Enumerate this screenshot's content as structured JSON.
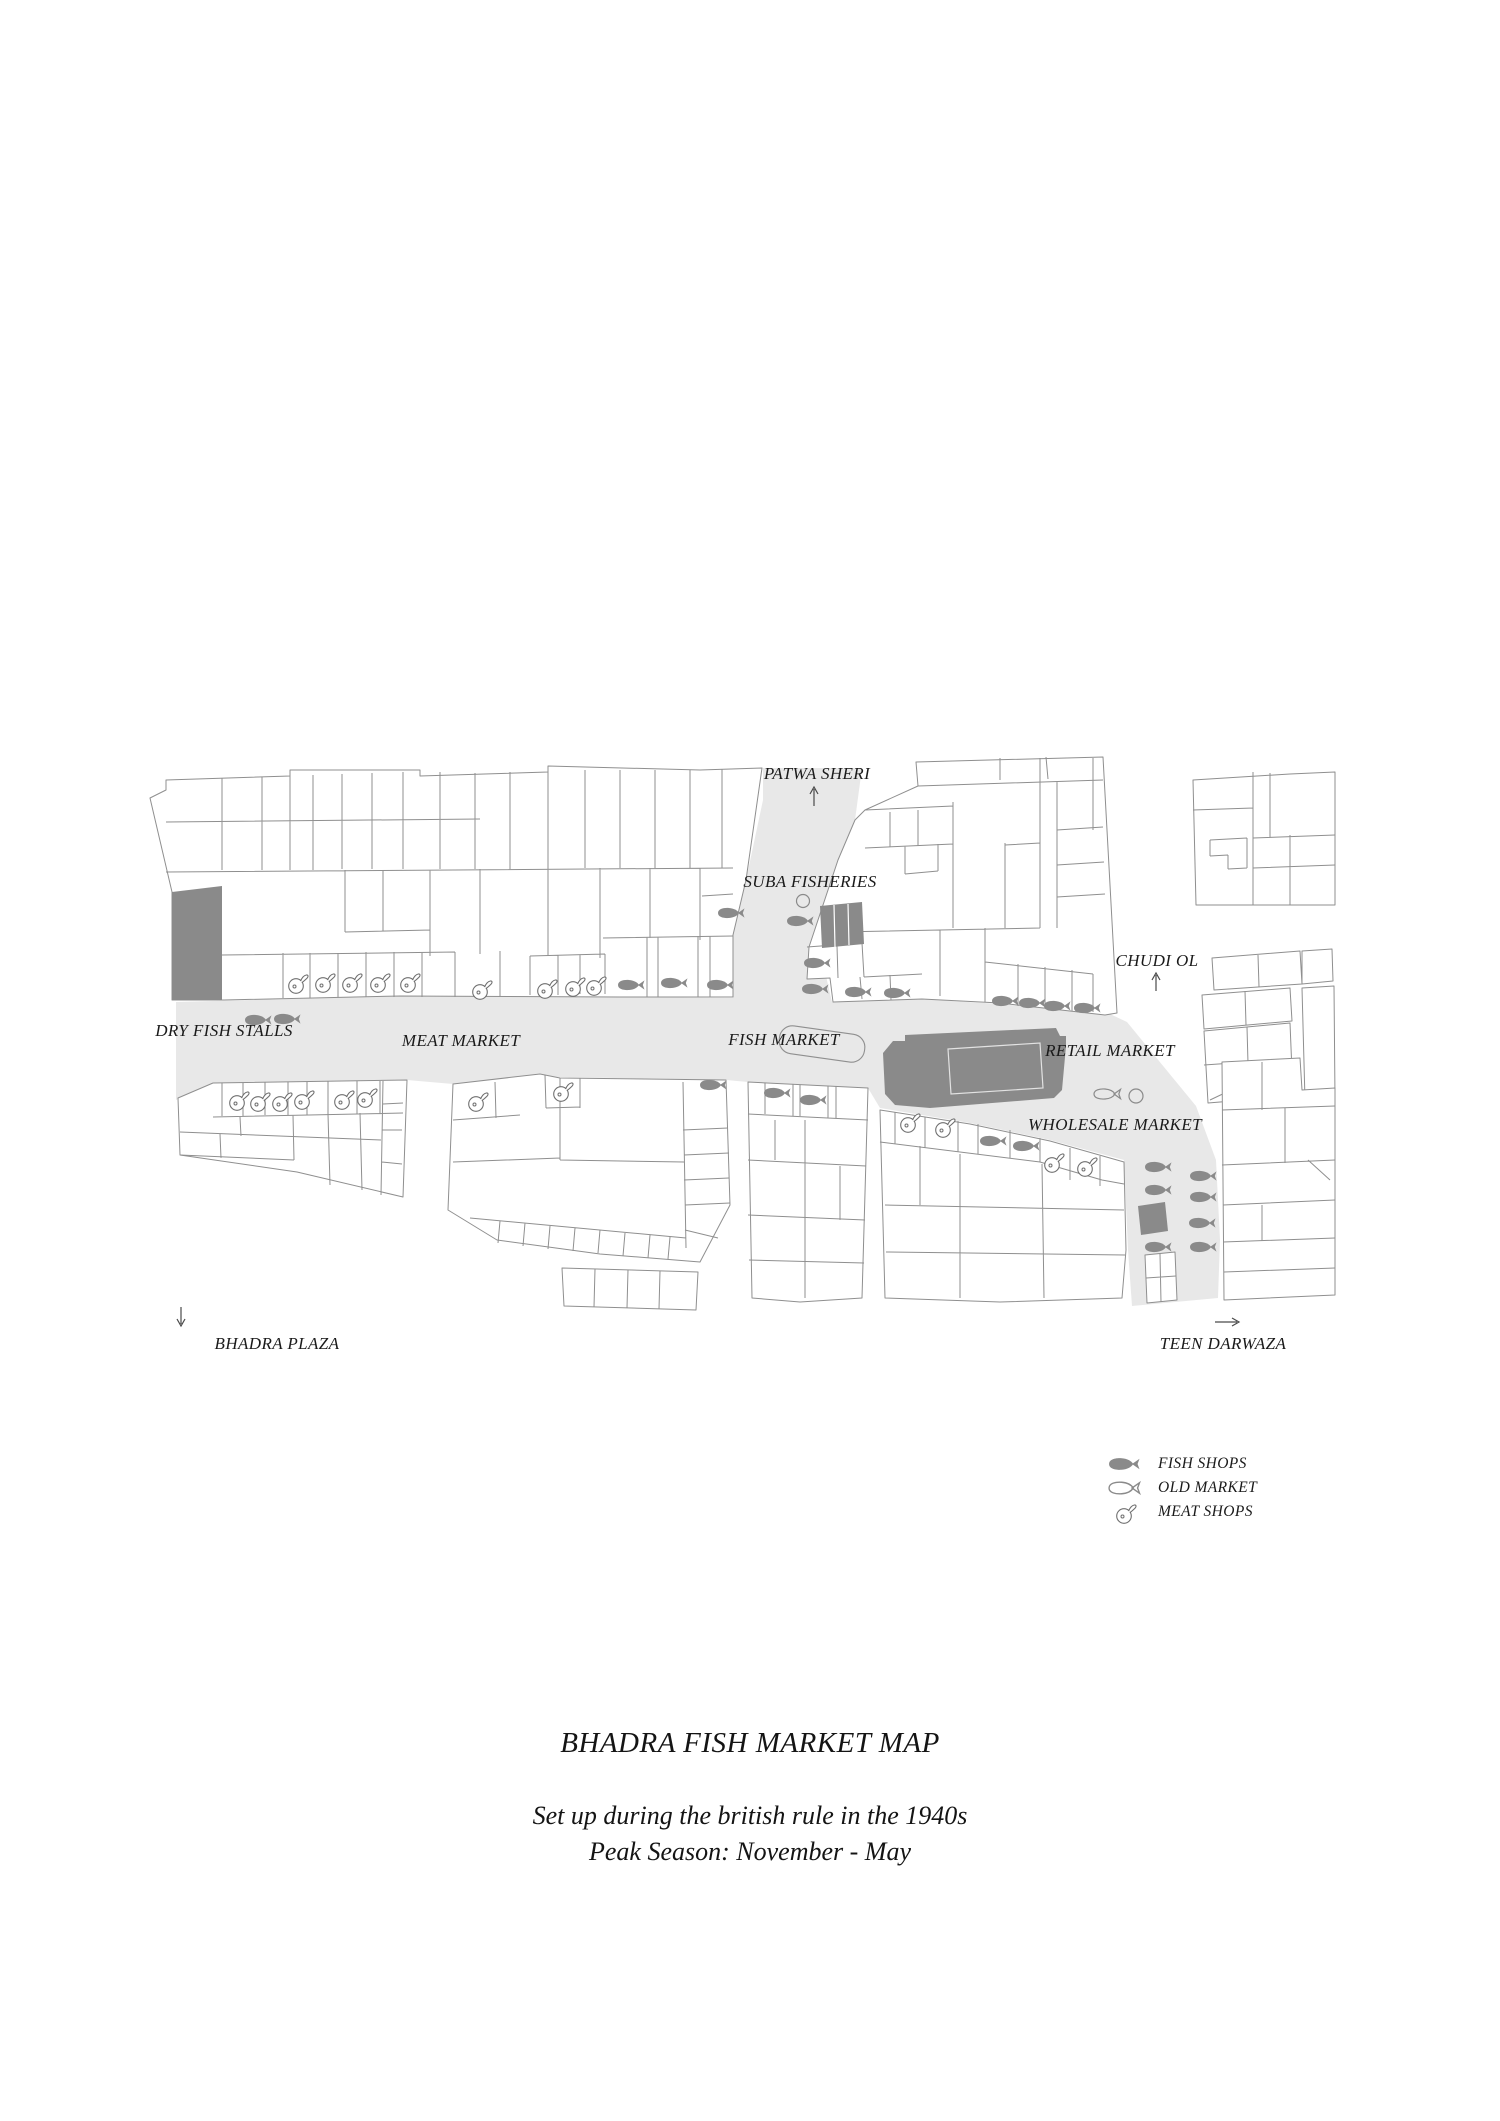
{
  "map": {
    "street_labels": {
      "patwa_sheri": "PATWA SHERI",
      "chudi_ol": "CHUDI OL",
      "teen_darwaza": "TEEN DARWAZA",
      "bhadra_plaza": "BHADRA PLAZA"
    },
    "area_labels": {
      "suba_fisheries": "SUBA FISHERIES",
      "dry_fish_stalls": "DRY FISH STALLS",
      "meat_market": "MEAT MARKET",
      "fish_market": "FISH MARKET",
      "retail_market": "RETAIL MARKET",
      "wholesale_market": "WHOLESALE MARKET"
    },
    "colors": {
      "street": "#e8e8e8",
      "building_outline": "#8f8f8f",
      "dark_building": "#8a8a8a",
      "icon_gray": "#8a8a8a",
      "text": "#1a1a1a"
    }
  },
  "legend": {
    "items": [
      {
        "icon": "fish-solid-icon",
        "label": "FISH SHOPS"
      },
      {
        "icon": "fish-outline-icon",
        "label": "OLD MARKET"
      },
      {
        "icon": "meat-outline-icon",
        "label": "MEAT SHOPS"
      }
    ]
  },
  "footer": {
    "title": "BHADRA FISH MARKET MAP",
    "subtitle_line1": "Set up during the british rule in the 1940s",
    "subtitle_line2": "Peak Season: November - May"
  }
}
